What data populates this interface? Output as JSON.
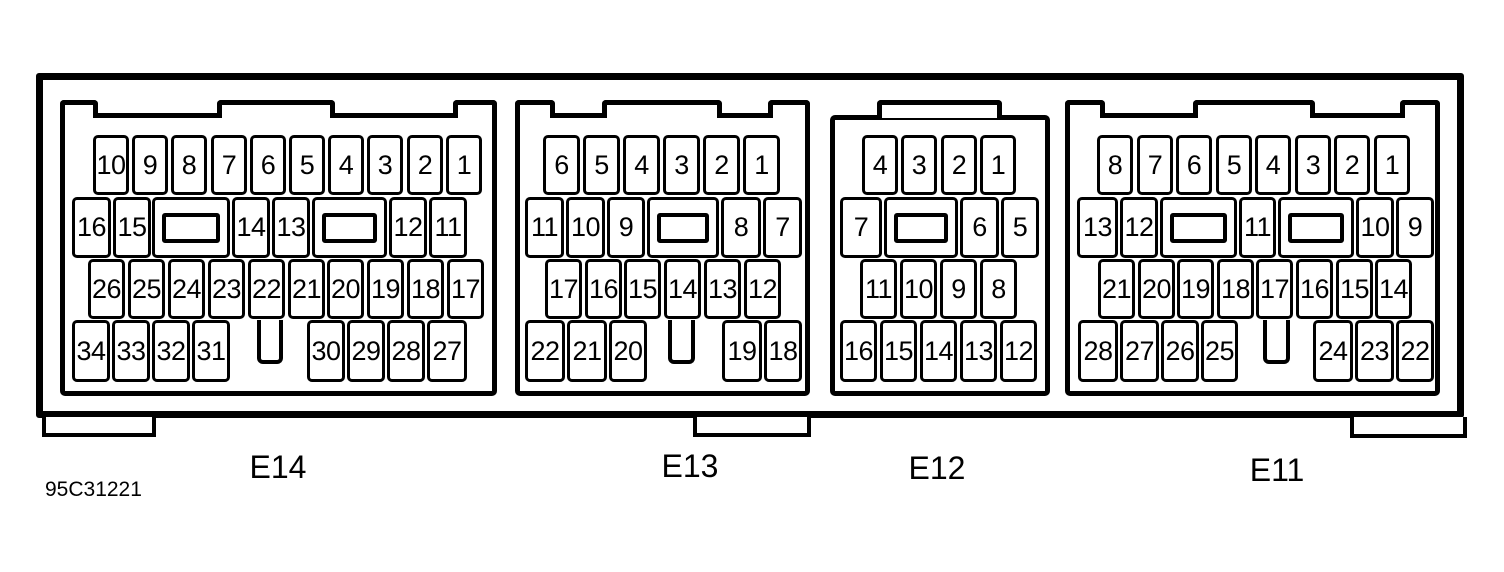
{
  "figure_label": "95C31221",
  "connectors": [
    {
      "id": "E14",
      "label": "E14",
      "rows": [
        {
          "pins": [
            "10",
            "9",
            "8",
            "7",
            "6",
            "5",
            "4",
            "3",
            "2",
            "1"
          ]
        },
        {
          "pins": [
            "16",
            "15",
            "14",
            "13",
            "12",
            "11"
          ]
        },
        {
          "pins": [
            "26",
            "25",
            "24",
            "23",
            "22",
            "21",
            "20",
            "19",
            "18",
            "17"
          ]
        },
        {
          "pins": [
            "34",
            "33",
            "32",
            "31",
            "30",
            "29",
            "28",
            "27"
          ]
        }
      ]
    },
    {
      "id": "E13",
      "label": "E13",
      "rows": [
        {
          "pins": [
            "6",
            "5",
            "4",
            "3",
            "2",
            "1"
          ]
        },
        {
          "pins": [
            "11",
            "10",
            "9",
            "8",
            "7"
          ]
        },
        {
          "pins": [
            "17",
            "16",
            "15",
            "14",
            "13",
            "12"
          ]
        },
        {
          "pins": [
            "22",
            "21",
            "20",
            "19",
            "18"
          ]
        }
      ]
    },
    {
      "id": "E12",
      "label": "E12",
      "rows": [
        {
          "pins": [
            "4",
            "3",
            "2",
            "1"
          ]
        },
        {
          "pins": [
            "7",
            "6",
            "5"
          ]
        },
        {
          "pins": [
            "11",
            "10",
            "9",
            "8"
          ]
        },
        {
          "pins": [
            "16",
            "15",
            "14",
            "13",
            "12"
          ]
        }
      ]
    },
    {
      "id": "E11",
      "label": "E11",
      "rows": [
        {
          "pins": [
            "8",
            "7",
            "6",
            "5",
            "4",
            "3",
            "2",
            "1"
          ]
        },
        {
          "pins": [
            "13",
            "12",
            "11",
            "10",
            "9"
          ]
        },
        {
          "pins": [
            "21",
            "20",
            "19",
            "18",
            "17",
            "16",
            "15",
            "14"
          ]
        },
        {
          "pins": [
            "28",
            "27",
            "26",
            "25",
            "24",
            "23",
            "22"
          ]
        }
      ]
    }
  ]
}
